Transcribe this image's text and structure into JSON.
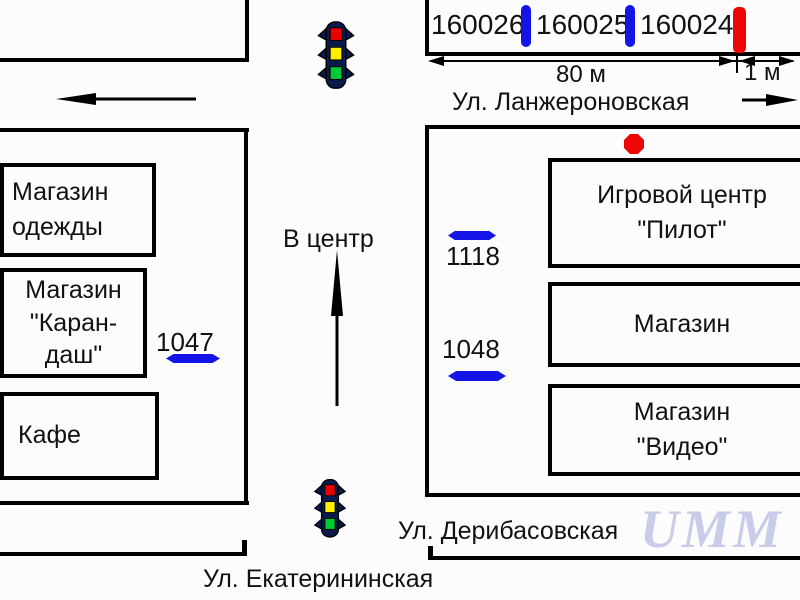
{
  "colors": {
    "marker_blue": "#1414e6",
    "marker_red": "#ee0505",
    "watermark": "#c9cce9",
    "light_red": "#ee0000",
    "light_yellow": "#ffee00",
    "light_green": "#00cc33"
  },
  "streets": {
    "lanzheronovskaya": "Ул. Ланжероновская",
    "deribasovskaya": "Ул. Дерибасовская",
    "ekaterininskaya": "Ул. Екатерининская"
  },
  "measure": {
    "main": "80 м",
    "small": "1 м"
  },
  "direction_label": "В центр",
  "billboards": {
    "top": [
      {
        "id": "160026",
        "marker_color": "blue"
      },
      {
        "id": "160025",
        "marker_color": "blue"
      },
      {
        "id": "160024",
        "marker_color": "red"
      }
    ],
    "left": [
      {
        "id": "1047",
        "marker_color": "blue"
      }
    ],
    "right": [
      {
        "id": "1118",
        "marker_color": "blue"
      },
      {
        "id": "1048",
        "marker_color": "blue"
      }
    ]
  },
  "buildings": {
    "left": [
      {
        "lines": [
          "Магазин",
          "одежды"
        ]
      },
      {
        "lines": [
          "Магазин",
          "\"Каран-",
          "даш\""
        ]
      },
      {
        "lines": [
          "Кафе"
        ]
      }
    ],
    "right": [
      {
        "lines": [
          "Игровой центр",
          "\"Пилот\""
        ]
      },
      {
        "lines": [
          "Магазин"
        ]
      },
      {
        "lines": [
          "Магазин",
          "\"Видео\""
        ]
      }
    ]
  },
  "watermark": "UMM"
}
